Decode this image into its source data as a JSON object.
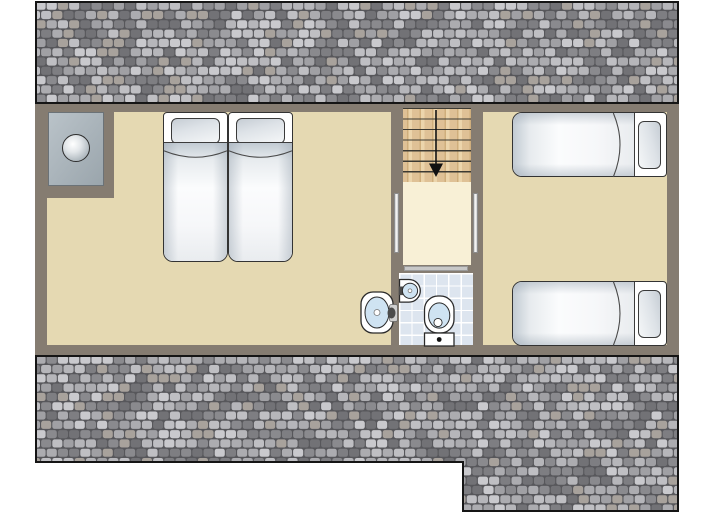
{
  "canvas": {
    "width": 713,
    "height": 519,
    "background": "#ffffff"
  },
  "palette": {
    "canvas_bg": "#ffffff",
    "wall": "#857c71",
    "room_floor": "#e5d9b2",
    "landing_floor": "#f8f0d6",
    "stair_wood": "#dfc196",
    "stair_wood_dark": "#cfae7c",
    "stair_wood_light": "#ecd5ac",
    "tread_line": "#3c3a33",
    "bath_tile": "#dde5ef",
    "tile_grout": "#ffffff",
    "basin_blue": "#cfe3f2",
    "fixture_outline": "#2a2a2a",
    "bed_outline": "#333333",
    "door_opening": "#f2f2f2",
    "door_opening_border": "#8c8c8c",
    "bath_door": "#c8c8c8",
    "arrow": "#111111",
    "unit_gray_light": "#bac3c9",
    "unit_gray_dark": "#9aa5ac",
    "roof_gap": "#57575b",
    "roof_outline": "#151515"
  },
  "roof_shades": [
    "#c9c9cd",
    "#b6b6ba",
    "#a0a0a4",
    "#8a8a8e",
    "#727276",
    "#acacb0",
    "#bfbfc3",
    "#7e7e82",
    "#a8a29c"
  ],
  "stairs": {
    "treads": 7,
    "direction": "down"
  },
  "rooms": {
    "left_bedroom": {
      "fixtures": [
        "double-bed",
        "washbasin",
        "utility-unit"
      ]
    },
    "hallway": {
      "fixtures": [
        "staircase-down",
        "landing"
      ]
    },
    "bathroom": {
      "fixtures": [
        "washbasin",
        "toilet",
        "door"
      ]
    },
    "right_bedroom": {
      "fixtures": [
        "single-bed",
        "single-bed"
      ]
    }
  }
}
